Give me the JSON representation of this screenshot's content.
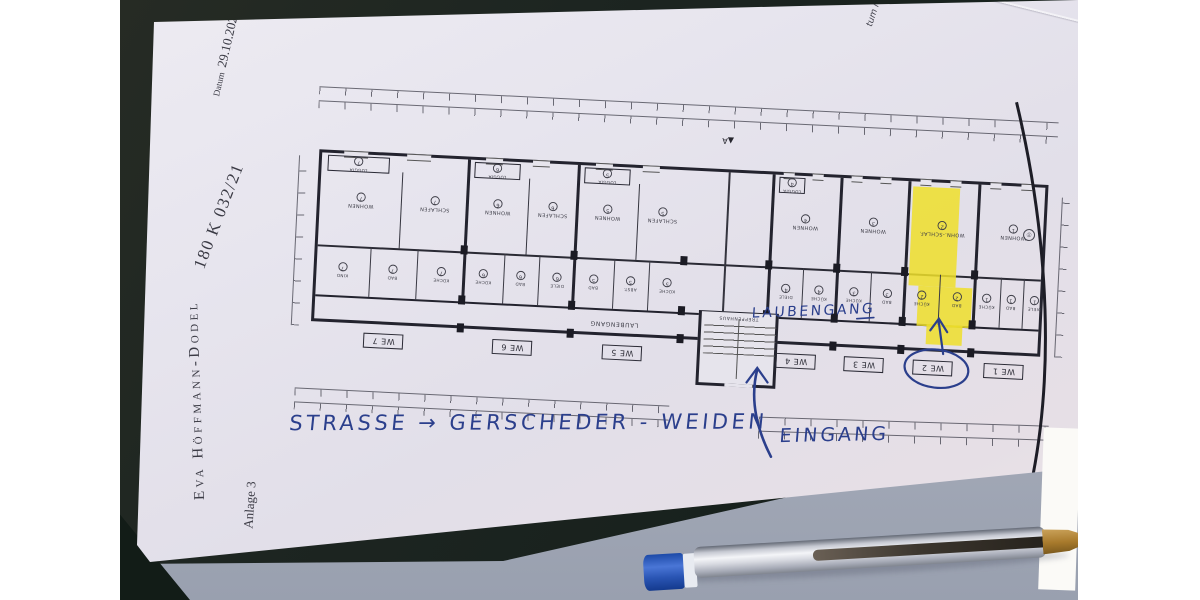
{
  "letterhead": {
    "date_label": "Datum",
    "date": "29.10.2021",
    "case_number": "180 K 032/21",
    "name": "Eva Höffmann-Dodel",
    "attachment": "Anlage 3"
  },
  "plan": {
    "side_note": "tum Nr. 2",
    "corridor_label": "LAUBENGANG",
    "stair_label": "TREPPENHAUS",
    "section_marker": "A",
    "highlight_color": "#eedf2a",
    "units": [
      {
        "we": "WE 7",
        "loggia": {
          "n": "LOGGIA",
          "c": "7"
        },
        "top": [
          {
            "n": "WOHNEN",
            "c": "7"
          },
          {
            "n": "SCHLAFEN",
            "c": "7"
          }
        ],
        "bottom": [
          {
            "n": "KIND",
            "c": "7"
          },
          {
            "n": "BAD",
            "c": "7"
          },
          {
            "n": "KÜCHE",
            "c": "7"
          }
        ]
      },
      {
        "we": "WE 6",
        "loggia": {
          "n": "LOGGIA",
          "c": "6"
        },
        "top": [
          {
            "n": "WOHNEN",
            "c": "6"
          },
          {
            "n": "SCHLAFEN",
            "c": "6"
          }
        ],
        "bottom": [
          {
            "n": "KÜCHE",
            "c": "6"
          },
          {
            "n": "BAD",
            "c": "6"
          },
          {
            "n": "DIELE",
            "c": "6"
          }
        ]
      },
      {
        "we": "WE 5",
        "loggia": {
          "n": "LOGGIA",
          "c": "5"
        },
        "top": [
          {
            "n": "WOHNEN",
            "c": "5"
          },
          {
            "n": "SCHLAFEN",
            "c": "5"
          }
        ],
        "bottom": [
          {
            "n": "BAD",
            "c": "5"
          },
          {
            "n": "ABST.",
            "c": "5"
          },
          {
            "n": "KÜCHE",
            "c": "5"
          }
        ]
      },
      {
        "we": "WE 4",
        "loggia": {
          "n": "LOGGIA",
          "c": "4"
        },
        "top": [
          {
            "n": "WOHNEN",
            "c": "4"
          }
        ],
        "bottom": [
          {
            "n": "DIELE",
            "c": "4"
          },
          {
            "n": "KÜCHE",
            "c": "4"
          }
        ]
      },
      {
        "we": "WE 3",
        "top": [
          {
            "n": "WOHNEN",
            "c": "3"
          }
        ],
        "bottom": [
          {
            "n": "KÜCHE",
            "c": "3"
          },
          {
            "n": "BAD",
            "c": "3"
          }
        ]
      },
      {
        "we": "WE 2",
        "highlight": true,
        "top": [
          {
            "n": "WOHN.-SCHLAF.",
            "c": "2"
          }
        ],
        "bottom": [
          {
            "n": "KÜCHE",
            "c": "2"
          },
          {
            "n": "BAD",
            "c": "2"
          }
        ]
      },
      {
        "we": "WE 1",
        "top": [
          {
            "n": "WOHNEN",
            "c": "1"
          }
        ],
        "bottom": [
          {
            "n": "KÜCHE",
            "c": "1"
          },
          {
            "n": "BAD",
            "c": "1"
          },
          {
            "n": "DIELE",
            "c": "1"
          }
        ]
      }
    ]
  },
  "annotations": {
    "ink_color": "#2b3f8c",
    "laubengang": "LAUBENGANG",
    "street": "STRASSE → GERSCHEDER - WEIDEN",
    "entrance": "EINGANG",
    "circled_unit": "WE 2"
  }
}
